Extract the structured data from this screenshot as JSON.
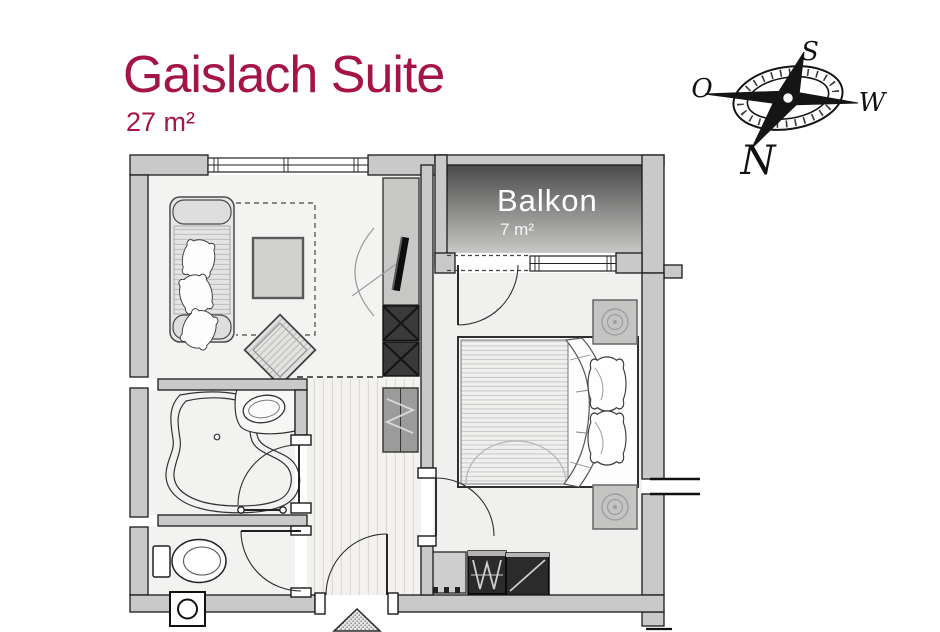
{
  "header": {
    "title": "Gaislach Suite",
    "area": "27 m²"
  },
  "balcony": {
    "label": "Balkon",
    "area": "7 m²"
  },
  "compass": {
    "labels": {
      "south": "S",
      "east": "O",
      "west": "W",
      "north": "N"
    }
  },
  "colors": {
    "accent": "#a51448",
    "wall_fill": "#c9c9c9",
    "wall_stroke": "#1a1a1a",
    "balcony_gradient_top": "#4a4a4a",
    "balcony_gradient_bottom": "#c8c8c6",
    "floor": "#f2f2f1",
    "balcony_text": "#ffffff",
    "dark_cabinet": "#2e2e2e"
  }
}
